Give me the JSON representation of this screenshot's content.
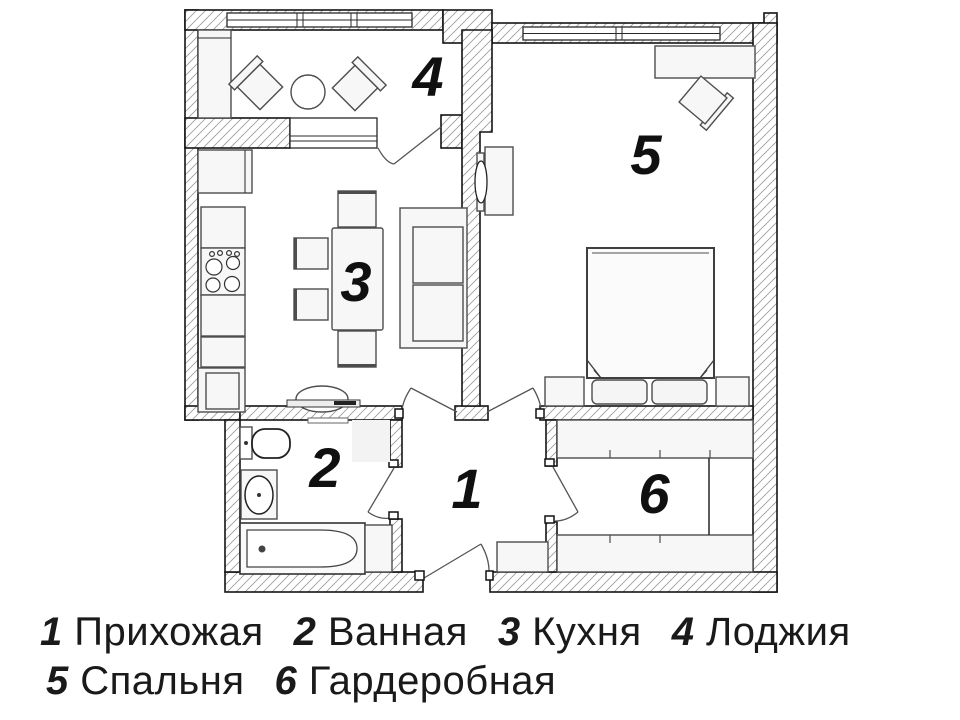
{
  "plan": {
    "rooms": [
      {
        "number": "1",
        "name": "Прихожая"
      },
      {
        "number": "2",
        "name": "Ванная"
      },
      {
        "number": "3",
        "name": "Кухня"
      },
      {
        "number": "4",
        "name": "Лоджия"
      },
      {
        "number": "5",
        "name": "Спальня"
      },
      {
        "number": "6",
        "name": "Гардеробная"
      }
    ]
  },
  "colors": {
    "wall_line": "#141414",
    "hatch_line": "#9e9e9e",
    "furniture_line": "#4d4d4d",
    "text": "#1a1a1a"
  }
}
